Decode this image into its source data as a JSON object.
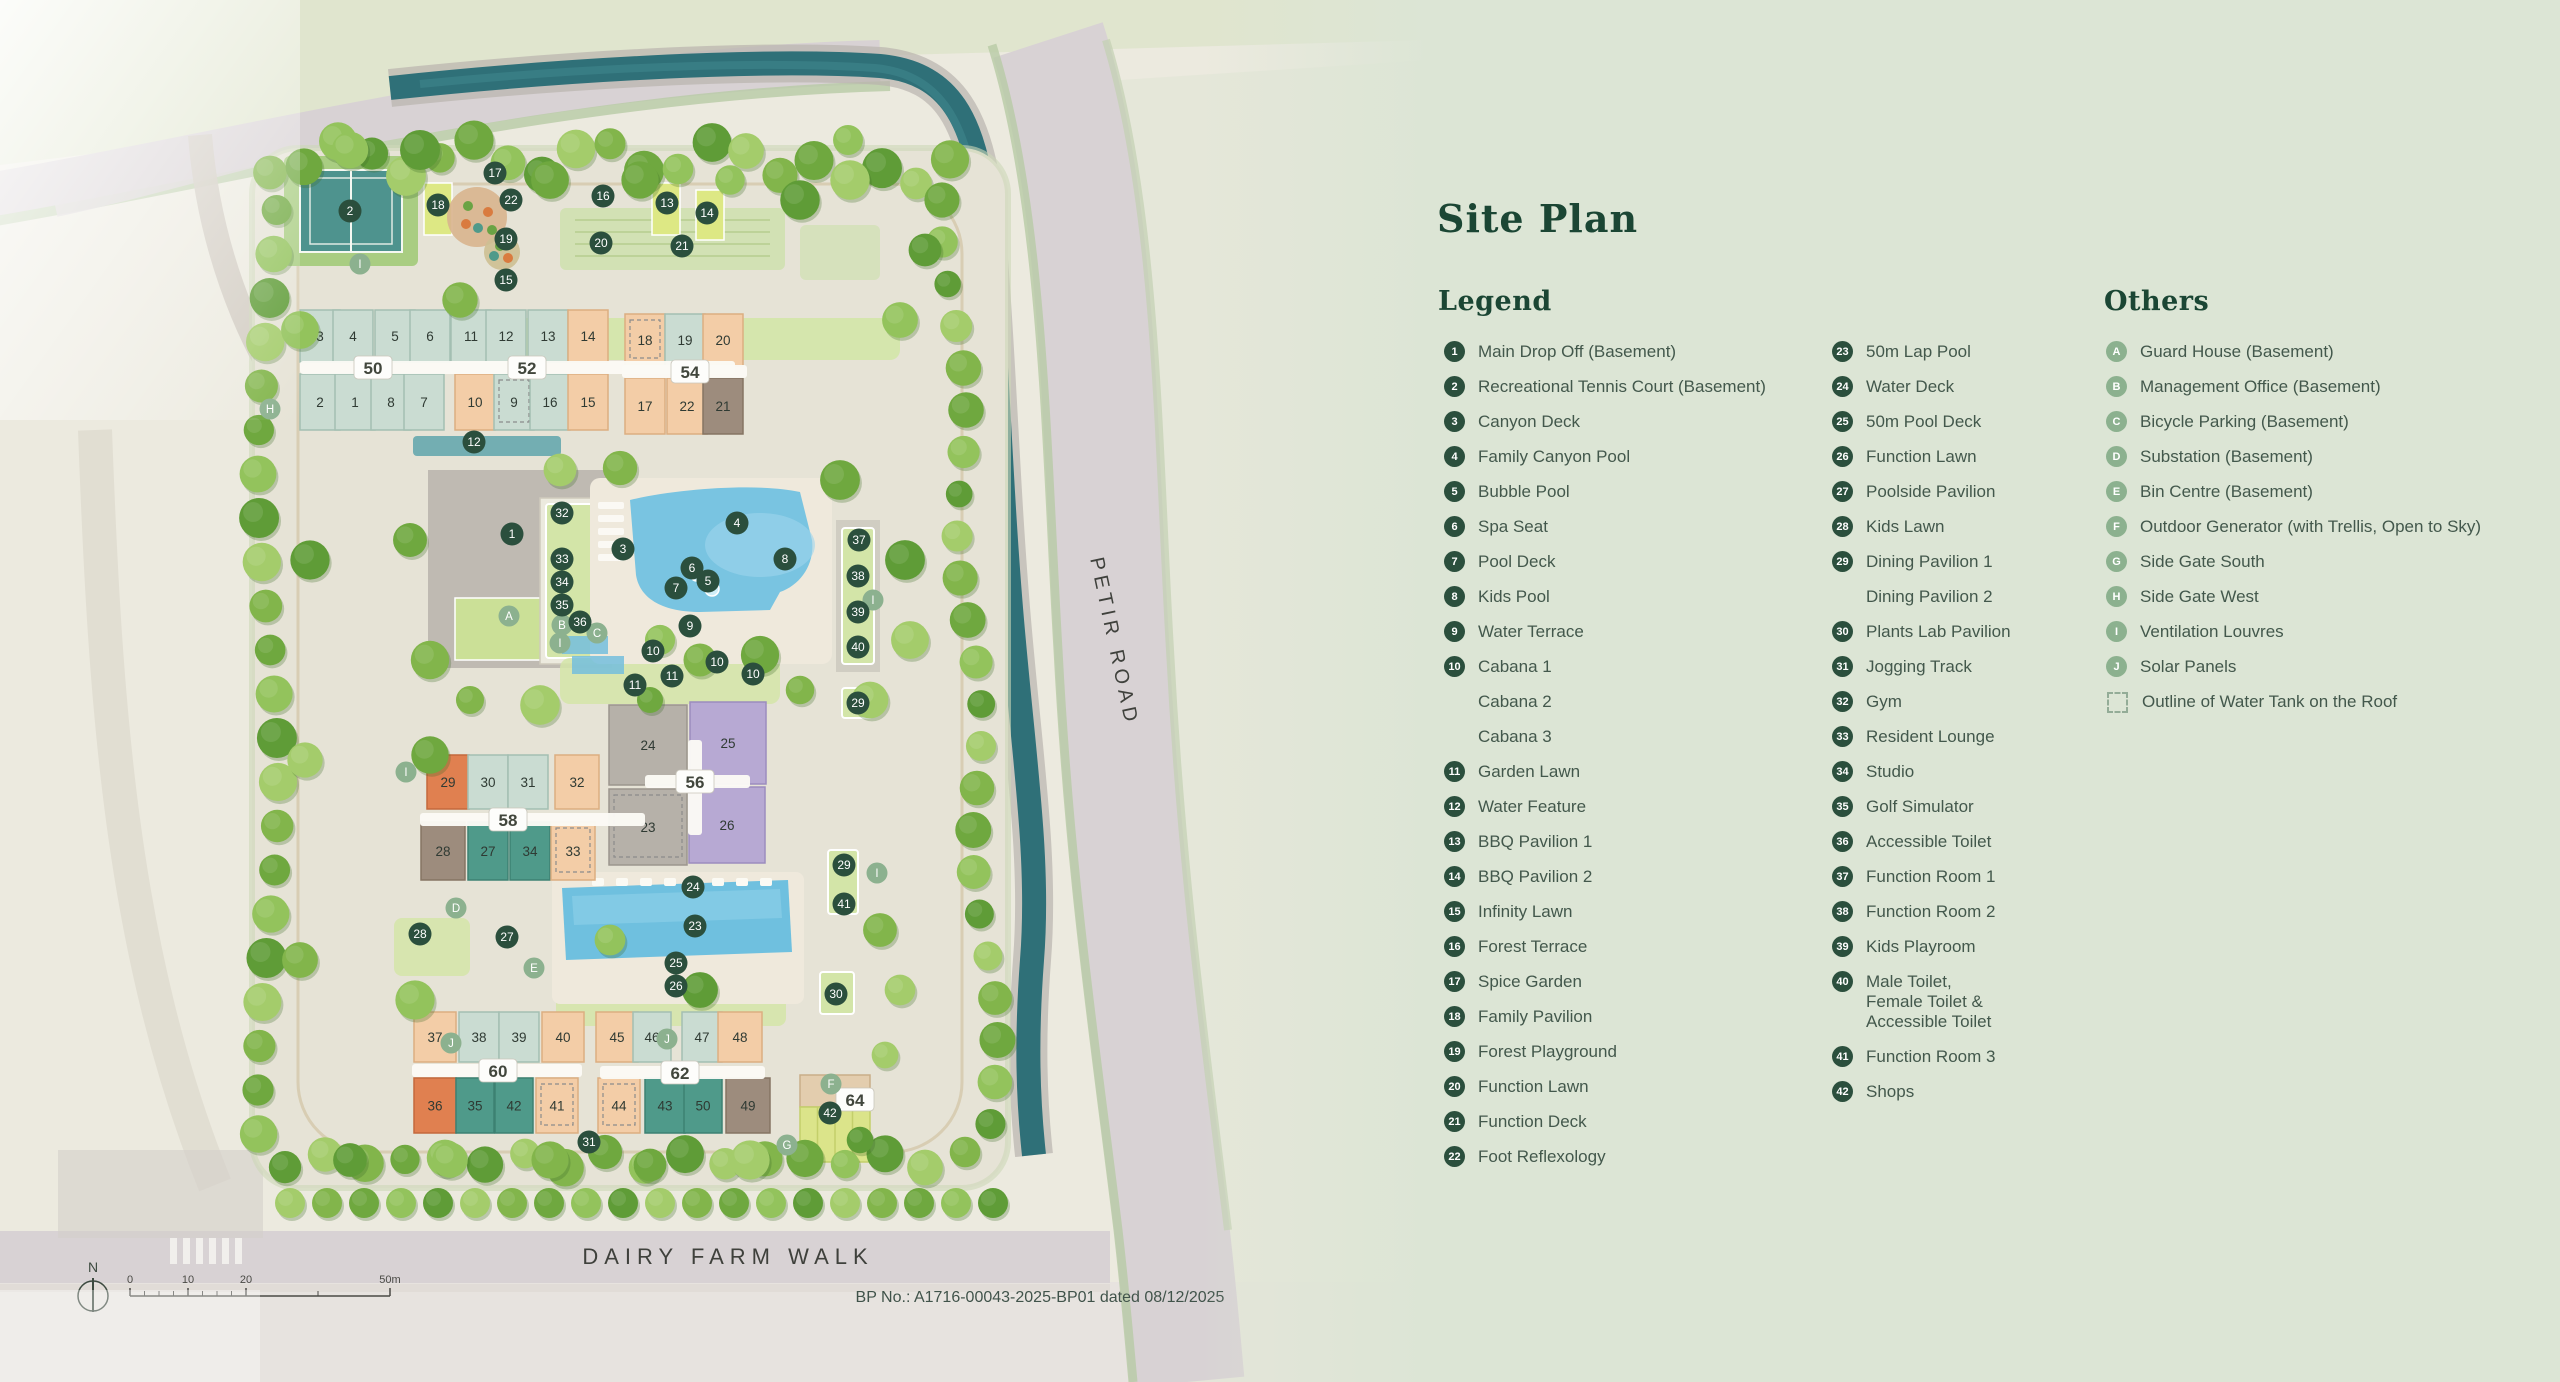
{
  "panel": {
    "title": "Site Plan",
    "legend_heading": "Legend",
    "others_heading": "Others",
    "legend_col1": [
      {
        "n": "1",
        "t": "Main Drop Off (Basement)"
      },
      {
        "n": "2",
        "t": "Recreational Tennis Court (Basement)"
      },
      {
        "n": "3",
        "t": "Canyon Deck"
      },
      {
        "n": "4",
        "t": "Family Canyon Pool"
      },
      {
        "n": "5",
        "t": "Bubble Pool"
      },
      {
        "n": "6",
        "t": "Spa Seat"
      },
      {
        "n": "7",
        "t": "Pool Deck"
      },
      {
        "n": "8",
        "t": "Kids Pool"
      },
      {
        "n": "9",
        "t": "Water Terrace"
      },
      {
        "n": "10",
        "t": "Cabana 1"
      },
      {
        "n": "",
        "t": "Cabana 2"
      },
      {
        "n": "",
        "t": "Cabana 3"
      },
      {
        "n": "11",
        "t": "Garden Lawn"
      },
      {
        "n": "12",
        "t": "Water Feature"
      },
      {
        "n": "13",
        "t": "BBQ Pavilion 1"
      },
      {
        "n": "14",
        "t": "BBQ Pavilion 2"
      },
      {
        "n": "15",
        "t": "Infinity Lawn"
      },
      {
        "n": "16",
        "t": "Forest Terrace"
      },
      {
        "n": "17",
        "t": "Spice Garden"
      },
      {
        "n": "18",
        "t": "Family Pavilion"
      },
      {
        "n": "19",
        "t": "Forest Playground"
      },
      {
        "n": "20",
        "t": "Function Lawn"
      },
      {
        "n": "21",
        "t": "Function Deck"
      },
      {
        "n": "22",
        "t": "Foot Reflexology"
      }
    ],
    "legend_col2": [
      {
        "n": "23",
        "t": "50m Lap Pool"
      },
      {
        "n": "24",
        "t": "Water Deck"
      },
      {
        "n": "25",
        "t": "50m Pool Deck"
      },
      {
        "n": "26",
        "t": "Function Lawn"
      },
      {
        "n": "27",
        "t": "Poolside Pavilion"
      },
      {
        "n": "28",
        "t": "Kids Lawn"
      },
      {
        "n": "29",
        "t": "Dining Pavilion 1"
      },
      {
        "n": "",
        "t": "Dining Pavilion 2"
      },
      {
        "n": "30",
        "t": "Plants Lab Pavilion"
      },
      {
        "n": "31",
        "t": "Jogging Track"
      },
      {
        "n": "32",
        "t": "Gym"
      },
      {
        "n": "33",
        "t": "Resident Lounge"
      },
      {
        "n": "34",
        "t": "Studio"
      },
      {
        "n": "35",
        "t": "Golf Simulator"
      },
      {
        "n": "36",
        "t": "Accessible Toilet"
      },
      {
        "n": "37",
        "t": "Function Room 1"
      },
      {
        "n": "38",
        "t": "Function Room 2"
      },
      {
        "n": "39",
        "t": "Kids Playroom"
      },
      {
        "n": "40",
        "t": "Male Toilet,\nFemale Toilet &\nAccessible Toilet"
      },
      {
        "n": "41",
        "t": "Function Room 3"
      },
      {
        "n": "42",
        "t": "Shops"
      }
    ],
    "others": [
      {
        "n": "A",
        "t": "Guard House (Basement)"
      },
      {
        "n": "B",
        "t": "Management Office (Basement)"
      },
      {
        "n": "C",
        "t": "Bicycle Parking (Basement)"
      },
      {
        "n": "D",
        "t": "Substation (Basement)"
      },
      {
        "n": "E",
        "t": "Bin Centre (Basement)"
      },
      {
        "n": "F",
        "t": "Outdoor Generator (with Trellis, Open to Sky)"
      },
      {
        "n": "G",
        "t": "Side Gate South"
      },
      {
        "n": "H",
        "t": "Side Gate West"
      },
      {
        "n": "I",
        "t": "Ventilation Louvres"
      },
      {
        "n": "J",
        "t": "Solar Panels"
      },
      {
        "n": "SQ",
        "t": "Outline of Water Tank on the Roof"
      }
    ]
  },
  "map": {
    "road_labels": {
      "petir": "PETIR ROAD",
      "dairy": "DAIRY FARM WALK"
    },
    "bp_note": "BP No.: A1716-00043-2025-BP01 dated 08/12/2025",
    "north_label": "N",
    "scale_labels": [
      {
        "t": "0",
        "x": 130
      },
      {
        "t": "10",
        "x": 188
      },
      {
        "t": "20",
        "x": 246
      },
      {
        "t": "50m",
        "x": 390
      }
    ],
    "colors": {
      "marker": "#2b4f3d",
      "marker_text": "#ffffff",
      "letter": "#8cb18f",
      "teal": "#cadcd2",
      "teal_s": "#a3bfb2",
      "peach": "#f3cda7",
      "peach_s": "#dcae81",
      "orange": "#e08050",
      "orange_s": "#c4693c",
      "midteal": "#4f9a8a",
      "midteal_s": "#3d8173",
      "purple": "#b7a9d3",
      "purple_s": "#9c8cbe",
      "brown": "#9d8c7d",
      "brown_s": "#857463",
      "gray": "#b6b1a9",
      "gray_s": "#9c968d",
      "lawn": "#d3e5a8",
      "brightlawn": "#dde884",
      "pool": "#79c4e1",
      "canal": "#2f7078",
      "road": "#d8d2d4",
      "court": "#4e938e",
      "panel_bg": "#dce5d5"
    },
    "block_pills": [
      {
        "t": "50",
        "x": 373,
        "y": 368
      },
      {
        "t": "52",
        "x": 527,
        "y": 368
      },
      {
        "t": "54",
        "x": 690,
        "y": 372
      },
      {
        "t": "56",
        "x": 695,
        "y": 782
      },
      {
        "t": "58",
        "x": 508,
        "y": 820
      },
      {
        "t": "60",
        "x": 498,
        "y": 1071
      },
      {
        "t": "62",
        "x": 680,
        "y": 1073
      },
      {
        "t": "64",
        "x": 855,
        "y": 1100
      }
    ],
    "strips": [
      [
        300,
        361,
        225,
        13
      ],
      [
        450,
        361,
        285,
        13
      ],
      [
        622,
        365,
        125,
        13
      ],
      [
        420,
        813,
        225,
        13
      ],
      [
        645,
        775,
        105,
        13
      ],
      [
        412,
        1064,
        170,
        13
      ],
      [
        600,
        1066,
        165,
        13
      ]
    ],
    "vstrips": [
      [
        688,
        740,
        14,
        95
      ]
    ],
    "units": [
      {
        "t": "3",
        "x": 320,
        "y": 310,
        "w": 40,
        "h": 52,
        "c": "teal"
      },
      {
        "t": "4",
        "x": 353,
        "y": 310,
        "w": 40,
        "h": 52,
        "c": "teal"
      },
      {
        "t": "5",
        "x": 395,
        "y": 310,
        "w": 40,
        "h": 52,
        "c": "teal"
      },
      {
        "t": "6",
        "x": 430,
        "y": 310,
        "w": 40,
        "h": 52,
        "c": "teal"
      },
      {
        "t": "2",
        "x": 320,
        "y": 374,
        "w": 40,
        "h": 56,
        "c": "teal"
      },
      {
        "t": "1",
        "x": 355,
        "y": 374,
        "w": 40,
        "h": 56,
        "c": "teal"
      },
      {
        "t": "8",
        "x": 391,
        "y": 374,
        "w": 40,
        "h": 56,
        "c": "teal"
      },
      {
        "t": "7",
        "x": 424,
        "y": 374,
        "w": 40,
        "h": 56,
        "c": "teal"
      },
      {
        "t": "11",
        "x": 471,
        "y": 310,
        "w": 40,
        "h": 52,
        "c": "teal"
      },
      {
        "t": "12",
        "x": 506,
        "y": 310,
        "w": 40,
        "h": 52,
        "c": "teal"
      },
      {
        "t": "13",
        "x": 548,
        "y": 310,
        "w": 40,
        "h": 52,
        "c": "teal"
      },
      {
        "t": "14",
        "x": 588,
        "y": 310,
        "w": 40,
        "h": 52,
        "c": "peach"
      },
      {
        "t": "10",
        "x": 475,
        "y": 374,
        "w": 40,
        "h": 56,
        "c": "peach"
      },
      {
        "t": "9",
        "x": 514,
        "y": 374,
        "w": 40,
        "h": 56,
        "c": "teal",
        "dash": true
      },
      {
        "t": "16",
        "x": 550,
        "y": 374,
        "w": 40,
        "h": 56,
        "c": "teal"
      },
      {
        "t": "15",
        "x": 588,
        "y": 374,
        "w": 40,
        "h": 56,
        "c": "peach"
      },
      {
        "t": "18",
        "x": 645,
        "y": 314,
        "w": 40,
        "h": 52,
        "c": "peach",
        "dash": true
      },
      {
        "t": "19",
        "x": 685,
        "y": 314,
        "w": 40,
        "h": 52,
        "c": "teal"
      },
      {
        "t": "20",
        "x": 723,
        "y": 314,
        "w": 40,
        "h": 52,
        "c": "peach"
      },
      {
        "t": "17",
        "x": 645,
        "y": 378,
        "w": 40,
        "h": 56,
        "c": "peach"
      },
      {
        "t": "22",
        "x": 687,
        "y": 378,
        "w": 40,
        "h": 56,
        "c": "peach"
      },
      {
        "t": "21",
        "x": 723,
        "y": 378,
        "w": 40,
        "h": 56,
        "c": "brown"
      },
      {
        "t": "29",
        "x": 448,
        "y": 755,
        "w": 42,
        "h": 54,
        "c": "orange"
      },
      {
        "t": "30",
        "x": 488,
        "y": 755,
        "w": 40,
        "h": 54,
        "c": "teal"
      },
      {
        "t": "31",
        "x": 528,
        "y": 755,
        "w": 40,
        "h": 54,
        "c": "teal"
      },
      {
        "t": "32",
        "x": 577,
        "y": 755,
        "w": 44,
        "h": 54,
        "c": "peach"
      },
      {
        "t": "28",
        "x": 443,
        "y": 822,
        "w": 44,
        "h": 58,
        "c": "brown"
      },
      {
        "t": "27",
        "x": 488,
        "y": 822,
        "w": 40,
        "h": 58,
        "c": "midteal"
      },
      {
        "t": "34",
        "x": 530,
        "y": 822,
        "w": 40,
        "h": 58,
        "c": "midteal"
      },
      {
        "t": "33",
        "x": 573,
        "y": 822,
        "w": 44,
        "h": 58,
        "c": "peach",
        "dash": true
      },
      {
        "t": "24",
        "x": 648,
        "y": 705,
        "w": 78,
        "h": 80,
        "c": "gray"
      },
      {
        "t": "25",
        "x": 728,
        "y": 702,
        "w": 76,
        "h": 82,
        "c": "purple"
      },
      {
        "t": "23",
        "x": 648,
        "y": 789,
        "w": 78,
        "h": 76,
        "c": "gray",
        "dash": true
      },
      {
        "t": "26",
        "x": 727,
        "y": 787,
        "w": 76,
        "h": 76,
        "c": "purple"
      },
      {
        "t": "37",
        "x": 435,
        "y": 1012,
        "w": 42,
        "h": 50,
        "c": "peach"
      },
      {
        "t": "38",
        "x": 479,
        "y": 1012,
        "w": 40,
        "h": 50,
        "c": "teal"
      },
      {
        "t": "39",
        "x": 519,
        "y": 1012,
        "w": 40,
        "h": 50,
        "c": "teal"
      },
      {
        "t": "40",
        "x": 563,
        "y": 1012,
        "w": 42,
        "h": 50,
        "c": "peach"
      },
      {
        "t": "36",
        "x": 435,
        "y": 1078,
        "w": 42,
        "h": 55,
        "c": "orange"
      },
      {
        "t": "35",
        "x": 475,
        "y": 1078,
        "w": 38,
        "h": 55,
        "c": "midteal"
      },
      {
        "t": "42",
        "x": 514,
        "y": 1078,
        "w": 38,
        "h": 55,
        "c": "midteal"
      },
      {
        "t": "41",
        "x": 557,
        "y": 1078,
        "w": 42,
        "h": 55,
        "c": "peach",
        "dash": true
      },
      {
        "t": "45",
        "x": 617,
        "y": 1012,
        "w": 42,
        "h": 50,
        "c": "peach"
      },
      {
        "t": "46",
        "x": 652,
        "y": 1012,
        "w": 38,
        "h": 50,
        "c": "teal"
      },
      {
        "t": "47",
        "x": 702,
        "y": 1012,
        "w": 40,
        "h": 50,
        "c": "teal"
      },
      {
        "t": "48",
        "x": 740,
        "y": 1012,
        "w": 44,
        "h": 50,
        "c": "peach"
      },
      {
        "t": "44",
        "x": 619,
        "y": 1078,
        "w": 42,
        "h": 55,
        "c": "peach",
        "dash": true
      },
      {
        "t": "43",
        "x": 665,
        "y": 1078,
        "w": 40,
        "h": 55,
        "c": "midteal"
      },
      {
        "t": "50",
        "x": 703,
        "y": 1078,
        "w": 38,
        "h": 55,
        "c": "midteal"
      },
      {
        "t": "49",
        "x": 748,
        "y": 1078,
        "w": 44,
        "h": 55,
        "c": "brown"
      }
    ],
    "number_markers": [
      {
        "n": "2",
        "x": 350,
        "y": 211
      },
      {
        "n": "17",
        "x": 495,
        "y": 173
      },
      {
        "n": "22",
        "x": 511,
        "y": 200
      },
      {
        "n": "18",
        "x": 438,
        "y": 205
      },
      {
        "n": "19",
        "x": 506,
        "y": 239
      },
      {
        "n": "15",
        "x": 506,
        "y": 280
      },
      {
        "n": "16",
        "x": 603,
        "y": 196
      },
      {
        "n": "20",
        "x": 601,
        "y": 243
      },
      {
        "n": "13",
        "x": 667,
        "y": 203
      },
      {
        "n": "14",
        "x": 707,
        "y": 213
      },
      {
        "n": "21",
        "x": 682,
        "y": 246
      },
      {
        "n": "12",
        "x": 474,
        "y": 442
      },
      {
        "n": "1",
        "x": 512,
        "y": 534
      },
      {
        "n": "32",
        "x": 562,
        "y": 513
      },
      {
        "n": "33",
        "x": 562,
        "y": 559
      },
      {
        "n": "34",
        "x": 562,
        "y": 582
      },
      {
        "n": "35",
        "x": 562,
        "y": 605
      },
      {
        "n": "36",
        "x": 580,
        "y": 622
      },
      {
        "n": "3",
        "x": 623,
        "y": 549
      },
      {
        "n": "4",
        "x": 737,
        "y": 523
      },
      {
        "n": "6",
        "x": 692,
        "y": 568
      },
      {
        "n": "5",
        "x": 708,
        "y": 581
      },
      {
        "n": "7",
        "x": 676,
        "y": 588
      },
      {
        "n": "8",
        "x": 785,
        "y": 559
      },
      {
        "n": "9",
        "x": 690,
        "y": 626
      },
      {
        "n": "10",
        "x": 653,
        "y": 651
      },
      {
        "n": "10",
        "x": 717,
        "y": 662
      },
      {
        "n": "10",
        "x": 753,
        "y": 674
      },
      {
        "n": "11",
        "x": 635,
        "y": 685
      },
      {
        "n": "11",
        "x": 672,
        "y": 676
      },
      {
        "n": "37",
        "x": 859,
        "y": 540
      },
      {
        "n": "38",
        "x": 858,
        "y": 576
      },
      {
        "n": "39",
        "x": 858,
        "y": 612
      },
      {
        "n": "40",
        "x": 858,
        "y": 647
      },
      {
        "n": "29",
        "x": 858,
        "y": 703
      },
      {
        "n": "29",
        "x": 844,
        "y": 865
      },
      {
        "n": "41",
        "x": 844,
        "y": 904
      },
      {
        "n": "30",
        "x": 836,
        "y": 994
      },
      {
        "n": "24",
        "x": 693,
        "y": 887
      },
      {
        "n": "23",
        "x": 695,
        "y": 926
      },
      {
        "n": "25",
        "x": 676,
        "y": 963
      },
      {
        "n": "26",
        "x": 676,
        "y": 986
      },
      {
        "n": "27",
        "x": 507,
        "y": 937
      },
      {
        "n": "28",
        "x": 420,
        "y": 934
      },
      {
        "n": "31",
        "x": 589,
        "y": 1142
      },
      {
        "n": "42",
        "x": 830,
        "y": 1113
      }
    ],
    "letter_markers": [
      {
        "l": "A",
        "x": 509,
        "y": 616
      },
      {
        "l": "B",
        "x": 562,
        "y": 625
      },
      {
        "l": "C",
        "x": 597,
        "y": 633
      },
      {
        "l": "I",
        "x": 560,
        "y": 643
      },
      {
        "l": "I",
        "x": 360,
        "y": 264
      },
      {
        "l": "I",
        "x": 873,
        "y": 600
      },
      {
        "l": "I",
        "x": 877,
        "y": 873
      },
      {
        "l": "I",
        "x": 406,
        "y": 772
      },
      {
        "l": "H",
        "x": 270,
        "y": 409
      },
      {
        "l": "D",
        "x": 456,
        "y": 908
      },
      {
        "l": "E",
        "x": 534,
        "y": 968
      },
      {
        "l": "J",
        "x": 451,
        "y": 1043
      },
      {
        "l": "J",
        "x": 667,
        "y": 1039
      },
      {
        "l": "G",
        "x": 787,
        "y": 1145
      },
      {
        "l": "F",
        "x": 831,
        "y": 1084
      }
    ]
  }
}
